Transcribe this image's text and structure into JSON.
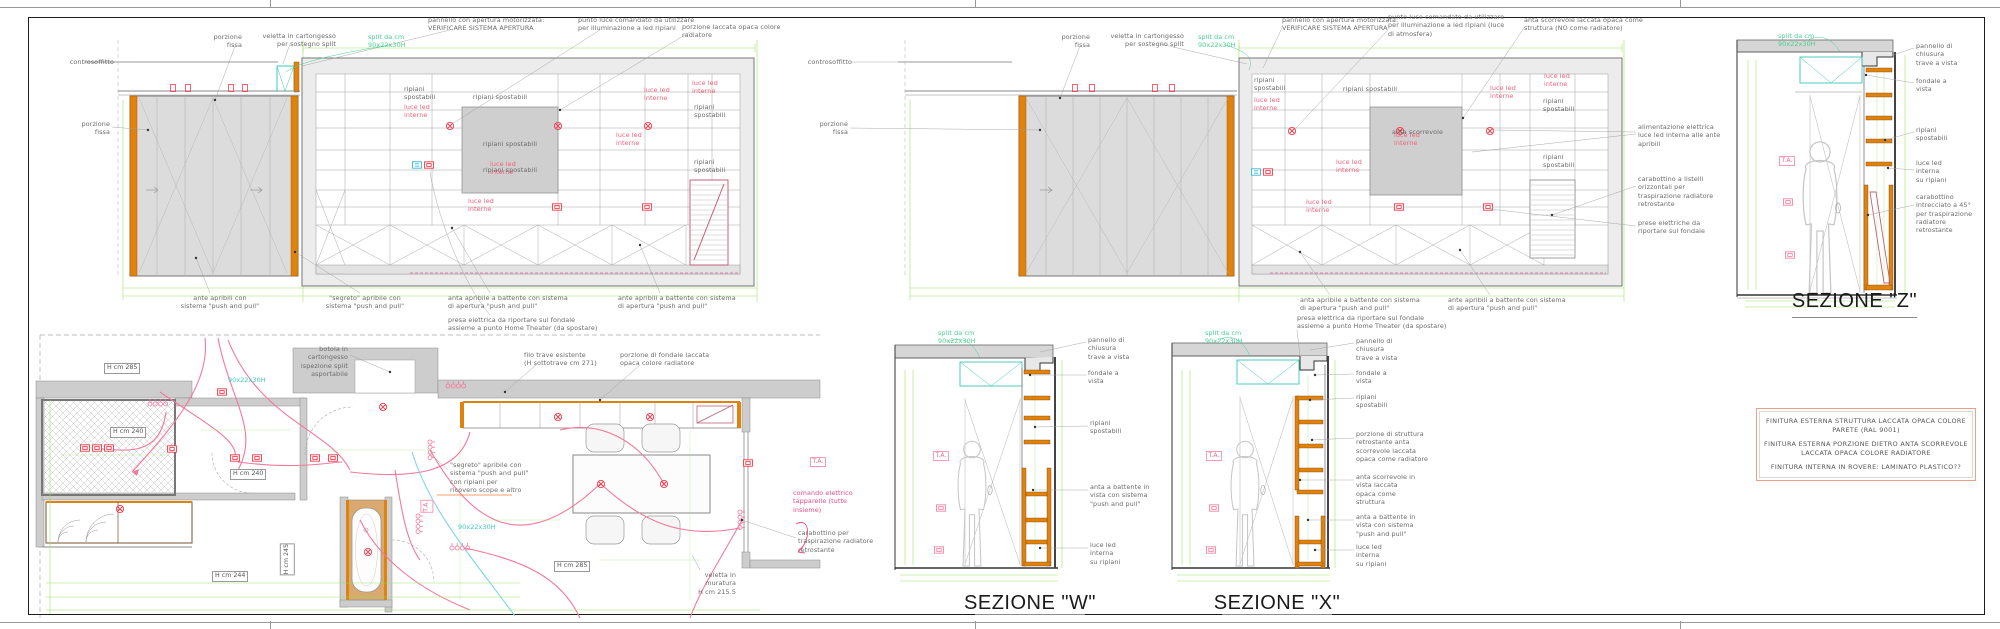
{
  "colors": {
    "cabinet_orange": "#df820e",
    "dimension_green": "#90e254",
    "annotation_red": "#f2607a",
    "electric_pink": "#f4789b",
    "split_cyan": "#3cc8bc",
    "wall_gray": "#cdcdcd",
    "radiator_pink": "#c06078"
  },
  "labels": {
    "controsoffitto": "controsoffitto",
    "porzione_fissa": "porzione\nfissa",
    "veletta_split": "veletta in cartongesso\nper sostegno split",
    "split_size": "split da cm\n90x22x30H",
    "pannello_motorizzato": "pannello con apertura motorizzata:\nVERIFICARE SISTEMA APERTURA",
    "punto_luce": "punto luce comandato da utilizzare\nper illuminazione a led ripiani",
    "punto_luce_atmosfera": "punto luce comandato da utilizzare\nper illuminazione a led ripiani (luce\ndi atmosfera)",
    "porzione_laccata": "porzione laccata opaca colore\nradiatore",
    "anta_scorrevole_top": "anta scorrevole laccata opaca come\nstruttura (NO come radiatore)",
    "ripiani_spostabili": "ripiani spostabili",
    "ripiani_spostabili_2l": "ripiani\nspostabili",
    "luce_led_interne": "luce led\ninterne",
    "anta_scorrevole": "anta scorrevole",
    "ante_apribili": "ante apribili con\nsistema \"push and pull\"",
    "segreto": "\"segreto\" apribile con\nsistema \"push and pull\"",
    "anta_battente": "anta apribile a battente con sistema\ndi apertura \"push and pull\"",
    "ante_battente": "ante apribili a battente con sistema\ndi apertura \"push and pull\"",
    "presa_home_theater": "presa elettrica da riportare sul fondale\nassieme a punto Home Theater (da spostare)",
    "alimentazione": "alimentazione elettrica\nluce led interna alle ante\napribili",
    "carabottino_listelli": "carabottino a listelli\norizzontali per\ntraspirazione radiatore\nretrostante",
    "prese_fondale": "prese elettriche da\nriportare sul fondale"
  },
  "sections": {
    "pannello_chiusura": "pannello di\nchiusura\ntrave a vista",
    "fondale_vista": "fondale a\nvista",
    "luce_led_ripiani": "luce led\ninterna\nsu ripiani",
    "carabottino_45": "carabottino\nintrecciato a 45°\nper traspirazione\nradiatore\nretrostante",
    "anta_battente_vista": "anta a battente in\nvista con sistema\n\"push and pull\"",
    "porzione_struttura": "porzione di struttura\nretrostante anta\nscorrevole laccata\nopaca come radiatore",
    "anta_scorrevole_vista": "anta scorrevole in\nvista laccata\nopaca come\nstruttura",
    "ta": "T.A.",
    "title_z": "SEZIONE \"Z\"",
    "title_w": "SEZIONE \"W\"",
    "title_x": "SEZIONE \"X\""
  },
  "plan": {
    "botola": "botola in\ncartongesso\nispezione split\nasportabile",
    "h285": "H cm 285",
    "h240": "H cm 240",
    "h244": "H cm 244",
    "h245": "H cm 245",
    "filo_trave": "filo trave esistente\n(H sottotrave cm 271)",
    "porzione_fondale": "porzione di fondale laccata\nopaca colore radiatore",
    "comando_tapparelle": "comando elettrico\ntapparelle (tutte\ninsieme)",
    "carabottino_plan": "carabottino per\ntraspirazione radiatore\nretrostante",
    "segreto_plan": "\"segreto\" apribile con\nsistema \"push and pull\"\ncon ripiani per\nricovero scope e altro",
    "veletta_muratura": "veletta in\nmuratura\nH cm 215.5",
    "split_dim": "90x22x30H"
  },
  "notes": {
    "line1": "FINITURA ESTERNA STRUTTURA LACCATA OPACA COLORE\nPARETE (RAL 9001)",
    "line2": "FINITURA ESTERNA PORZIONE DIETRO ANTA SCORREVOLE\nLACCATA OPACA COLORE RADIATORE",
    "line3": "FINITURA INTERNA IN ROVERE: LAMINATO PLASTICO??"
  }
}
